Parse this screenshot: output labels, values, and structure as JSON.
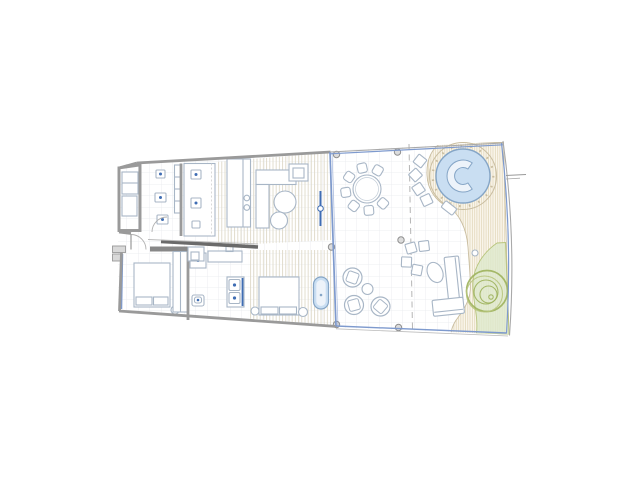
{
  "scene": {
    "type": "architectural-floor-plan",
    "description": "top-view apartment plan with covered terrace, circular pool deck and garden bed",
    "background": "#ffffff"
  },
  "colors": {
    "wall": "#9a9a9a",
    "wall_dark": "#6a6a6a",
    "furniture_line": "#a8b6c6",
    "glass_blue": "#7e9ace",
    "accent_blue": "#3f6db4",
    "water_fill": "#c9def2",
    "water_inner": "#edf3fa",
    "water_edge": "#85a5c6",
    "grid_line": "#e7eaee",
    "floor_stripe": "#dfd9c8",
    "deck_hatch_line": "#e0d5b6",
    "deck_hatch_bg": "#faf6ec",
    "deck_edge": "#c9bda0",
    "green_fill": "#dde9cc",
    "green_line": "#9db25c",
    "green_line_light": "#b8c57d",
    "column_fill": "#dcdcdc",
    "column_edge": "#8f8f8f",
    "dashed_line": "#b5b5b5"
  },
  "elements": {
    "interior": [
      "entry-room",
      "bathroom-top",
      "kitchen-counter",
      "kitchen-island",
      "living-sofa-l",
      "armchair",
      "coffee-tables",
      "tv-panel",
      "bedroom-1-bed",
      "wardrobe",
      "bathroom-middle-toilet",
      "shower",
      "double-sink-vanity",
      "bedroom-2-bed",
      "freestanding-bathtub"
    ],
    "outdoor": [
      "glass-facade",
      "terrace-grid",
      "dining-table",
      "lounge-chairs",
      "side-table",
      "roof-columns",
      "stepping-stones",
      "circular-pool",
      "pool-bench",
      "pool-deck",
      "outdoor-sofa-l",
      "outdoor-oval-table",
      "tree-canopy",
      "planting-bed",
      "property-boundary",
      "dimension-tick"
    ]
  },
  "plan": {
    "columns": [
      [
        336.5,
        154.5
      ],
      [
        331.5,
        247
      ],
      [
        336.5,
        324.5
      ],
      [
        397.5,
        152
      ],
      [
        401,
        240
      ],
      [
        398.5,
        327.5
      ]
    ],
    "stepping_stones": [
      [
        420,
        161
      ],
      [
        415.5,
        175
      ],
      [
        418.5,
        189
      ],
      [
        426.5,
        200
      ],
      [
        411,
        248
      ],
      [
        424,
        246
      ],
      [
        406.5,
        262
      ],
      [
        417,
        270
      ]
    ],
    "dining_set": {
      "cx": 367,
      "cy": 189,
      "table_r": 14,
      "table_inner_r": 11.5,
      "chair_ring_r": 21.5,
      "chair_size": 9.5,
      "chair_angles": [
        60,
        103,
        146,
        189,
        232,
        275,
        318
      ]
    },
    "lounge_chairs": [
      [
        352.5,
        277.5,
        20
      ],
      [
        354,
        305,
        -15
      ],
      [
        380.5,
        306.5,
        40
      ]
    ],
    "lounge_table": [
      367.5,
      289,
      5.5
    ],
    "tree_circles": [
      [
        487,
        291,
        20.5
      ],
      [
        484.5,
        294,
        18
      ],
      [
        486,
        292,
        12
      ],
      [
        488.5,
        294.5,
        8.5
      ],
      [
        491,
        297,
        2.2
      ]
    ]
  }
}
